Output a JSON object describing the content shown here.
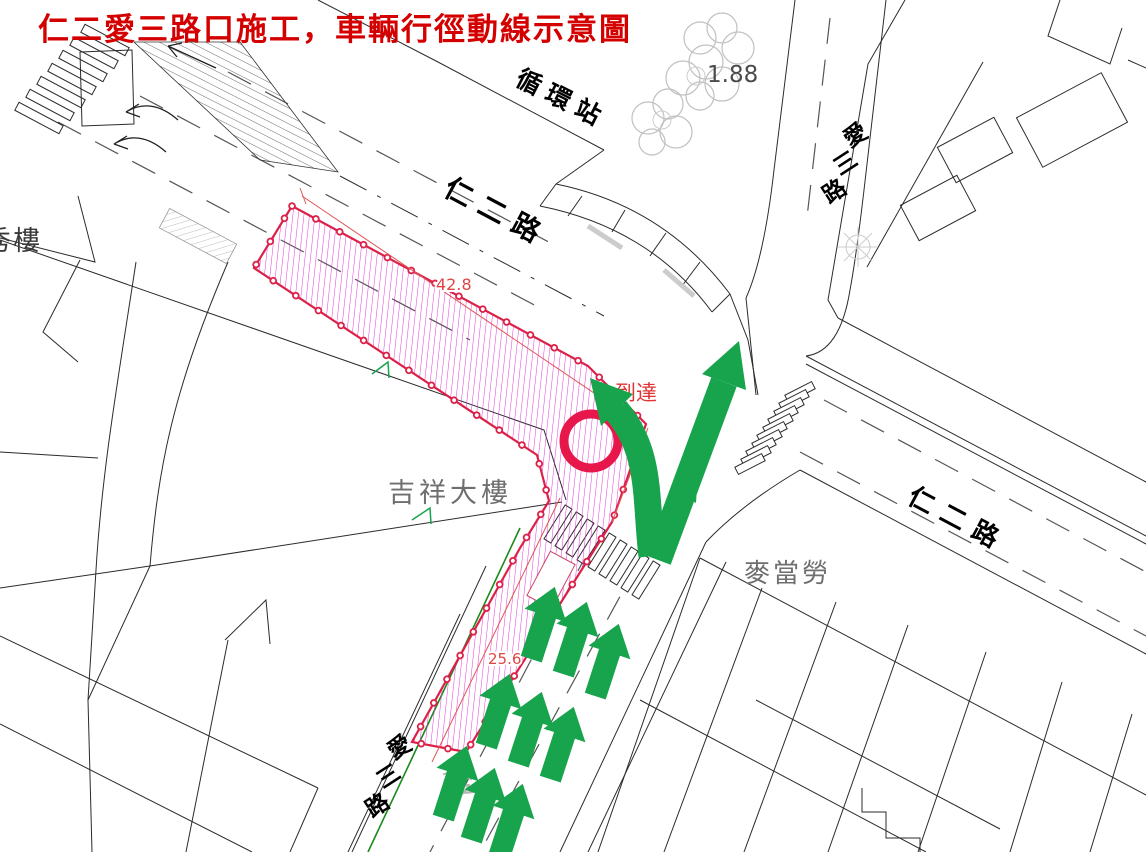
{
  "title": {
    "text": "仁二愛三路口施工，車輛行徑動線示意圖"
  },
  "map": {
    "road_labels": {
      "ren_er_west": "仁二路",
      "ren_er_east": "仁二路",
      "recycle_station": "循環站",
      "ai_san_north_chars": [
        "愛",
        "三",
        "路"
      ],
      "ai_san_south_chars": [
        "愛",
        "三",
        "路"
      ]
    },
    "place_labels": {
      "jixiang_building": "吉祥大樓",
      "mcdonalds": "麥當勞",
      "building_partial": "秀樓",
      "pavement_marking": "愛"
    },
    "annotations": {
      "dim_ren_er": "42.8",
      "dim_ai_san": "25.6",
      "dim_partial": "8",
      "elevation": "1.88",
      "arrival_note": "到達"
    },
    "colors": {
      "title_red": "#d40000",
      "construction_border": "#dc2148",
      "construction_hatch": "#e520cf",
      "dimension_red": "#e04545",
      "arrow_green": "#18a34d",
      "roadside_green": "#1a8a1a",
      "linework_black": "#2b2b2b",
      "label_gray": "#6f6f6f",
      "tree_gray": "#c0c0c0"
    }
  }
}
